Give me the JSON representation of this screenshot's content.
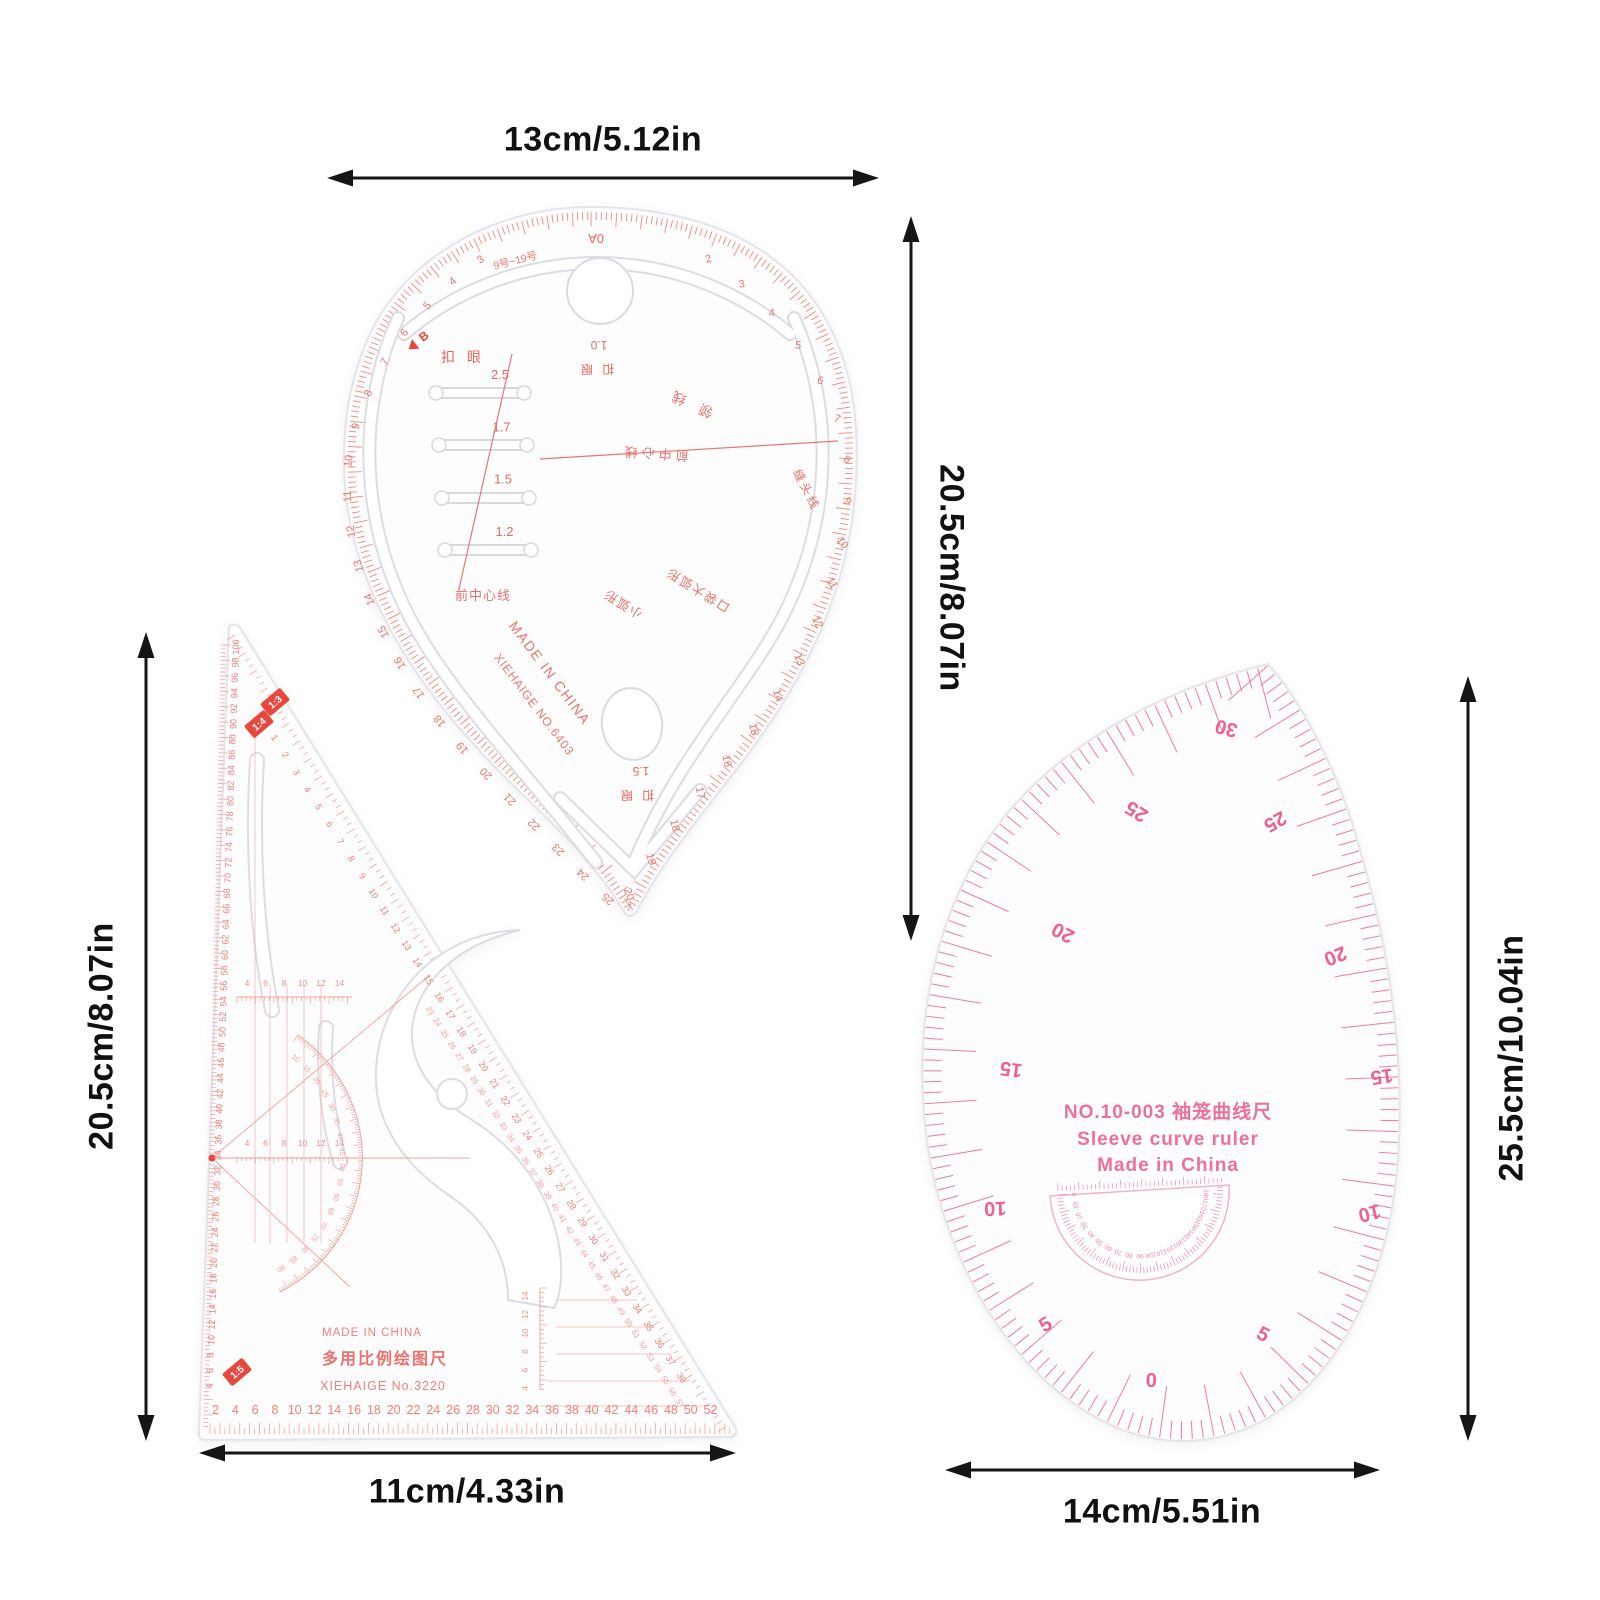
{
  "colors": {
    "teardrop_ink": "#e8685f",
    "teardrop_tick": "#ef8a80",
    "triangle_ink": "#f0807c",
    "badge_red": "#e8473d",
    "sleeve_ink": "#ee5f92",
    "sleeve_tick": "#f07ba2",
    "dimension_ink": "#111111"
  },
  "dimensions": {
    "teardrop_width": "13cm/5.12in",
    "teardrop_height": "20.5cm/8.07in",
    "triangle_height": "20.5cm/8.07in",
    "triangle_width": "11cm/4.33in",
    "sleeve_height": "25.5cm/10.04in",
    "sleeve_width": "14cm/5.51in"
  },
  "teardrop": {
    "top_mark": "0A",
    "size_range": "9号~19号",
    "b_mark": "B",
    "buttonhole_label": "扣 眼",
    "buttonhole_sizes": {
      "values": [
        "2.5",
        "1.7",
        "1.5",
        "1.2"
      ],
      "x": 500,
      "y": 379,
      "dx": 1.5,
      "dy": 52.3,
      "size": 13,
      "color": "#e8685f"
    },
    "front_center_bottom": "前中心线",
    "collar_line": "领 线",
    "front_center_mid": "前中心线",
    "seam_line": "缝头线",
    "small_arc": "小弧形",
    "pocket_arc": "口袋大弧形",
    "hole_small_value": "1.0",
    "hole_small_label": "扣 眼",
    "hole_large_value": "1.5",
    "hole_large_label": "扣 眼",
    "made_in": "MADE IN CHINA",
    "brand_no": "XIEHAIGE  NO.6403",
    "left_scale": {
      "values": [
        "3",
        "4",
        "5",
        "6",
        "7",
        "8",
        "9",
        "10",
        "11",
        "12",
        "13",
        "14",
        "15",
        "16",
        "17",
        "18",
        "19",
        "20",
        "21",
        "22",
        "23",
        "24",
        "25"
      ],
      "t0": 0.01,
      "t1": 0.99,
      "size": 11,
      "color": "#e8776e",
      "rotOff": -180
    },
    "right_scale": {
      "values": [
        "2",
        "3",
        "4",
        "5",
        "6",
        "7",
        "8",
        "9",
        "10",
        "11",
        "12",
        "13",
        "14",
        "15",
        "16",
        "17",
        "18",
        "19",
        "20"
      ],
      "t0": 0.01,
      "t1": 0.99,
      "size": 11,
      "color": "#e8776e",
      "rotOff": -50
    }
  },
  "triangle": {
    "made_in": "MADE IN CHINA",
    "product_name": "多用比例绘图尺",
    "brand_no": "XIEHAIGE  No.3220",
    "badge_13": "1:3",
    "badge_14": "1:4",
    "badge_15": "1:5",
    "left_scale": {
      "from": 100,
      "to": 4,
      "step": -2,
      "x": 239,
      "y": 647,
      "dx": -0.55,
      "dy": 15.4,
      "rot": -90,
      "size": 9,
      "color": "#f0807c"
    },
    "bottom_scale": {
      "from": 2,
      "to": 52,
      "step": 2,
      "x": 215.5,
      "y": 1414,
      "dx": 19.8,
      "dy": 0,
      "size": 12.5,
      "color": "#f0807c"
    },
    "hyp_scale_inner": {
      "from": 0,
      "to": 38,
      "step": 1,
      "x": 261,
      "y": 722,
      "dx": 11.0,
      "dy": 17.3,
      "rot": 57,
      "size": 9,
      "color": "#f0807c"
    },
    "hyp_scale_outer": {
      "from": 23,
      "to": 57,
      "step": 1,
      "x": 428,
      "y": 1012,
      "dx": 7.35,
      "dy": 11.55,
      "rot": 57,
      "size": 7.5,
      "color": "#f49c98"
    },
    "mini_scale_a": {
      "values": [
        "4",
        "6",
        "8",
        "10",
        "12",
        "14"
      ],
      "x": 247,
      "y": 986,
      "dx": 18.5,
      "dy": 0,
      "size": 8.5,
      "color": "#f0918c"
    },
    "mini_scale_b": {
      "values": [
        "4",
        "6",
        "8",
        "10",
        "12",
        "14"
      ],
      "x": 247,
      "y": 1146,
      "dx": 18.5,
      "dy": 0,
      "size": 8.5,
      "color": "#f0918c"
    },
    "mini_scale_v": {
      "values": [
        "14",
        "12",
        "10",
        "8",
        "6",
        "4"
      ],
      "x": 528,
      "y": 1296,
      "dx": 0,
      "dy": 18.5,
      "rot": -90,
      "size": 8,
      "color": "#f0918c"
    },
    "protractor": {
      "cx": 212,
      "cy": 1158,
      "r": 128,
      "a0": -50,
      "a1": 58,
      "rotOff": 90,
      "size": 7,
      "color": "#f49c98",
      "values": [
        "10",
        "15",
        "20",
        "25",
        "30",
        "35",
        "40",
        "45",
        "50",
        "55",
        "60",
        "65",
        "70",
        "75",
        "80",
        "85",
        "90"
      ]
    }
  },
  "sleeve": {
    "model_line": "NO.10-003  袖笼曲线尺",
    "name_line": "Sleeve curve ruler",
    "origin_line": "Made in China",
    "left_numbers": {
      "size": 20,
      "color": "#ee5f92",
      "weight": "bold",
      "items": [
        {
          "t": "30",
          "x": 1228,
          "y": 722,
          "r": 195
        },
        {
          "t": "25",
          "x": 1140,
          "y": 806,
          "r": -148
        },
        {
          "t": "20",
          "x": 1066,
          "y": 927,
          "r": -152
        },
        {
          "t": "15",
          "x": 1012,
          "y": 1063,
          "r": -172
        },
        {
          "t": "10",
          "x": 995,
          "y": 1202,
          "r": 178
        },
        {
          "t": "5",
          "x": 1049,
          "y": 1330,
          "r": -32
        },
        {
          "t": "0",
          "x": 1151,
          "y": 1387,
          "r": 2
        }
      ]
    },
    "right_numbers": {
      "size": 20,
      "color": "#ee5f92",
      "weight": "bold",
      "items": [
        {
          "t": "5",
          "x": 1260,
          "y": 1340,
          "r": 28
        },
        {
          "t": "10",
          "x": 1368,
          "y": 1207,
          "r": 166
        },
        {
          "t": "15",
          "x": 1381,
          "y": 1070,
          "r": 172
        },
        {
          "t": "20",
          "x": 1333,
          "y": 950,
          "r": 158
        },
        {
          "t": "25",
          "x": 1272,
          "y": 816,
          "r": 150
        }
      ]
    },
    "protractor": {
      "cx": 1140,
      "cy": 1190,
      "r": 64,
      "a0": 176,
      "a1": 4,
      "rotOff": 90,
      "size": 6.5,
      "color": "#f285a8",
      "values": [
        "0",
        "10",
        "20",
        "30",
        "40",
        "50",
        "60",
        "70",
        "80",
        "90",
        "100",
        "110",
        "120",
        "130",
        "140",
        "150",
        "160",
        "170",
        "180"
      ]
    }
  }
}
